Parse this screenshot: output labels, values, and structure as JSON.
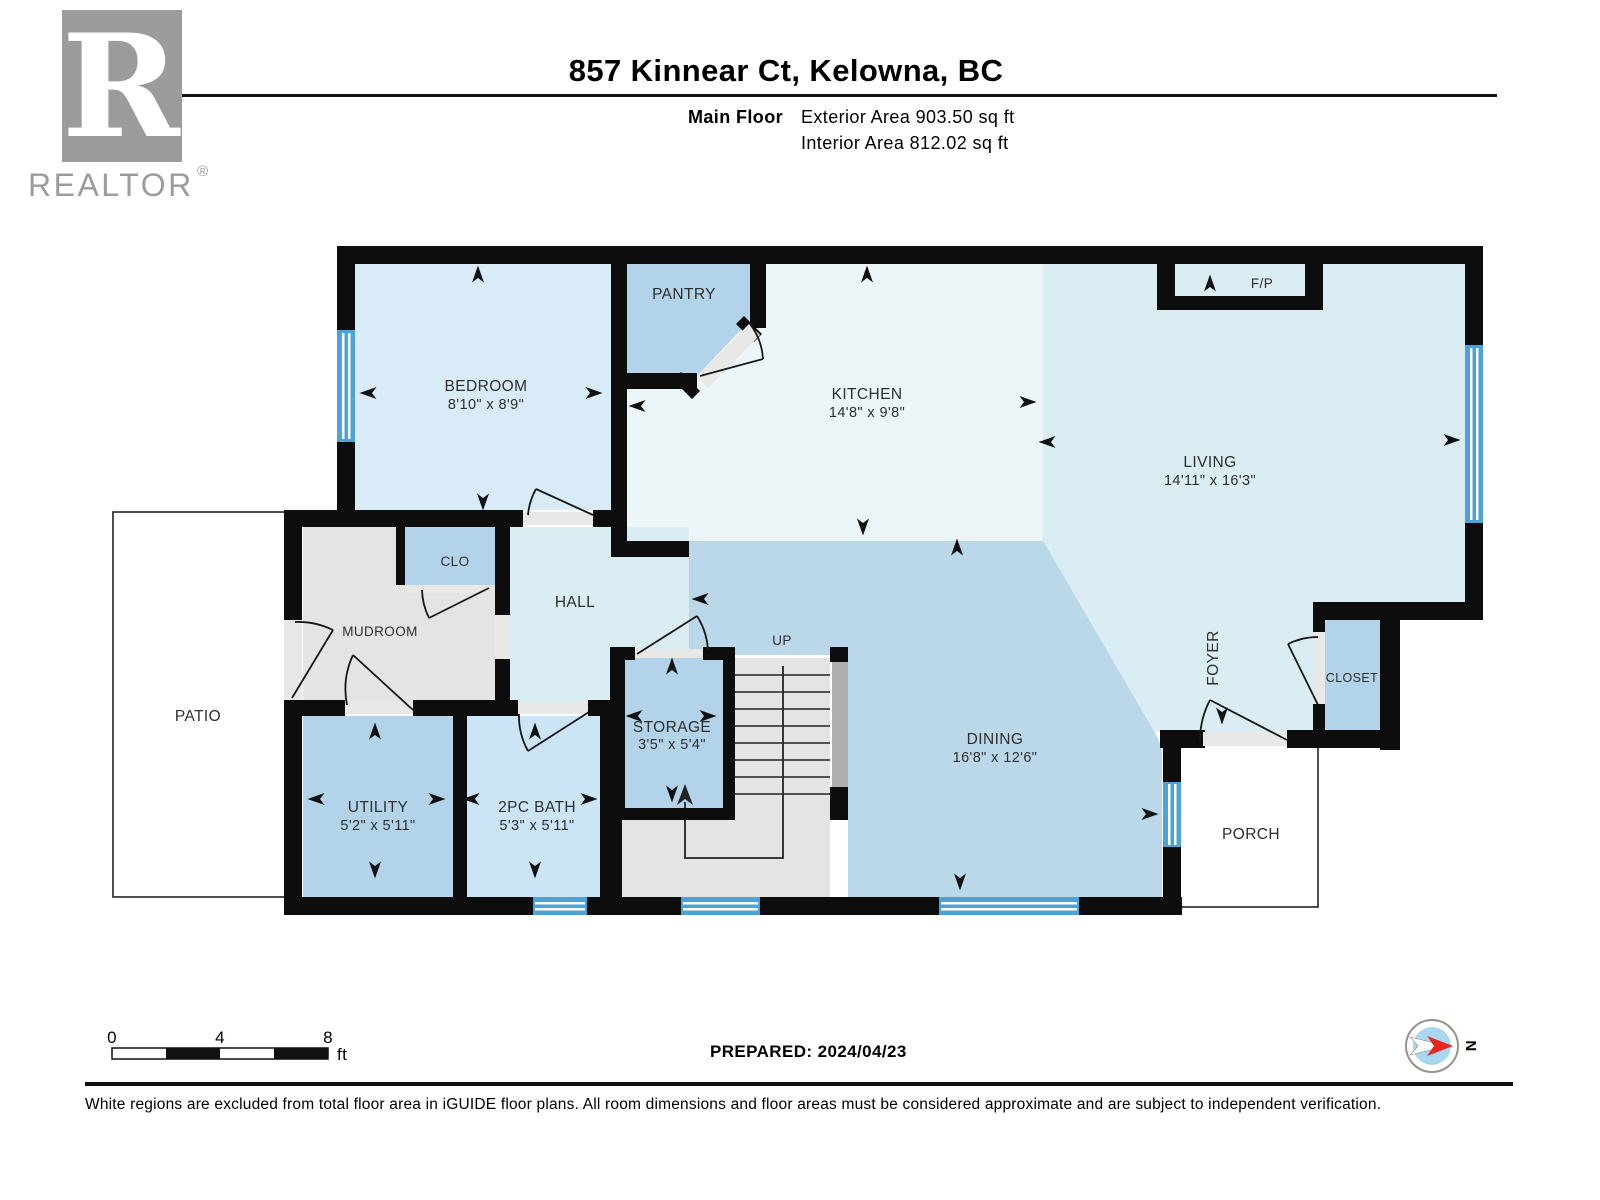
{
  "header": {
    "logo_letter": "R",
    "logo_brand": "REALTOR",
    "logo_registered": "®",
    "title": "857 Kinnear Ct, Kelowna, BC",
    "floor_label": "Main Floor",
    "exterior_area": "Exterior Area 903.50 sq ft",
    "interior_area": "Interior Area 812.02 sq ft"
  },
  "plan": {
    "rooms": {
      "bedroom": {
        "name": "BEDROOM",
        "dims": "8'10\" x 8'9\""
      },
      "pantry": {
        "name": "PANTRY"
      },
      "kitchen": {
        "name": "KITCHEN",
        "dims": "14'8\" x 9'8\""
      },
      "living": {
        "name": "LIVING",
        "dims": "14'11\" x 16'3\""
      },
      "fireplace": {
        "name": "F/P"
      },
      "hall": {
        "name": "HALL"
      },
      "mudroom": {
        "name": "MUDROOM"
      },
      "clo": {
        "name": "CLO"
      },
      "patio": {
        "name": "PATIO"
      },
      "storage": {
        "name": "STORAGE",
        "dims": "3'5\" x 5'4\""
      },
      "stairs_up": {
        "name": "UP"
      },
      "dining": {
        "name": "DINING",
        "dims": "16'8\" x 12'6\""
      },
      "foyer": {
        "name": "FOYER"
      },
      "closet": {
        "name": "CLOSET"
      },
      "utility": {
        "name": "UTILITY",
        "dims": "5'2\" x 5'11\""
      },
      "bath": {
        "name": "2PC BATH",
        "dims": "5'3\" x 5'11\""
      },
      "porch": {
        "name": "PORCH"
      }
    }
  },
  "footer": {
    "scale_ticks": [
      "0",
      "4",
      "8"
    ],
    "scale_unit": "ft",
    "prepared": "PREPARED: 2024/04/23",
    "compass_north": "N",
    "disclaimer": "White regions are excluded from total floor area in iGUIDE floor plans. All room dimensions and floor areas must be considered approximate and are subject to independent verification."
  },
  "colors": {
    "wall": "#0d0d0d",
    "room_light_cyan": "#d9edf2",
    "room_kitchen": "#ecf6f9",
    "room_bedroom": "#d8ebf7",
    "room_blue": "#b2d3ea",
    "room_dining": "#bad8ea",
    "room_bath": "#cbe5f6",
    "room_gray": "#e4e4e2",
    "window_blue": "#4ba3d8",
    "compass_fill": "#a9d7f0",
    "compass_needle": "#e8251f",
    "logo_gray": "#9c9c9c"
  }
}
